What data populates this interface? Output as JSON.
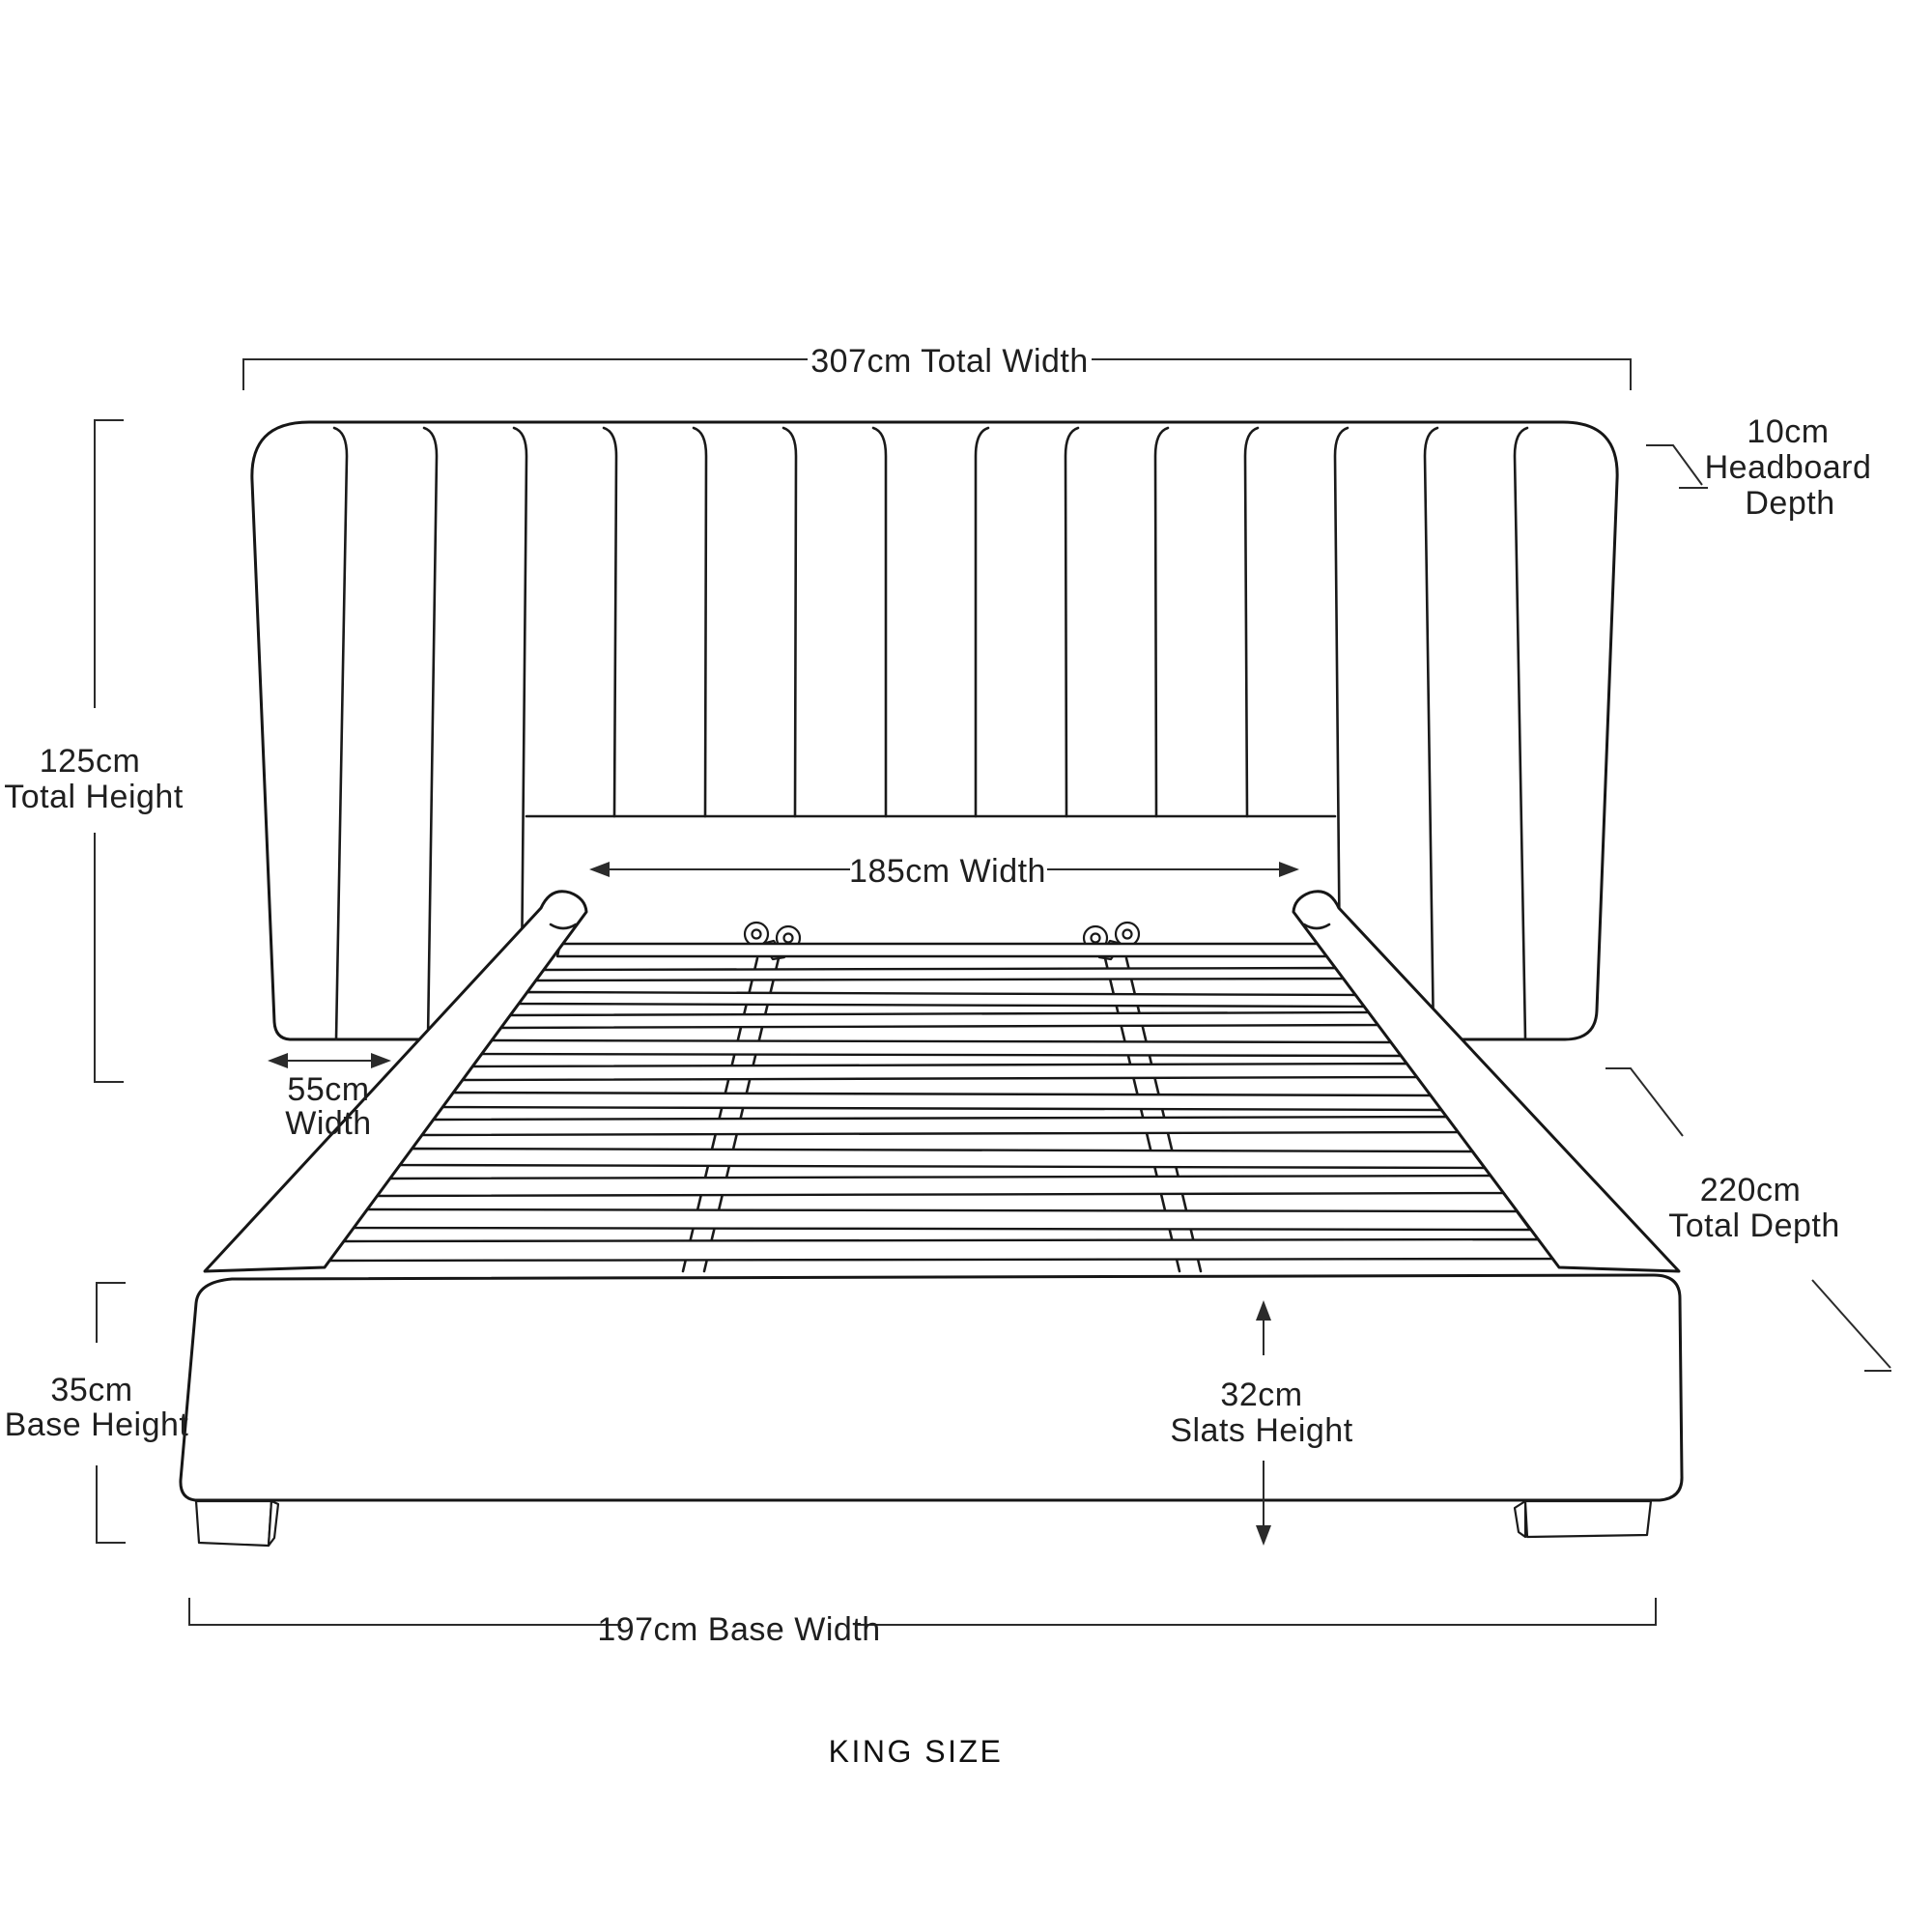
{
  "page": {
    "background": "#ffffff",
    "line_color": "#161616",
    "dimension_color": "#2b2b2b"
  },
  "diagram": {
    "labels": {
      "total_width": "307cm Total Width",
      "headboard_depth": [
        "10cm",
        "Headboard",
        "Depth"
      ],
      "total_height": [
        "125cm",
        "Total Height"
      ],
      "width": "185cm Width",
      "wing_width": [
        "55cm",
        "Width"
      ],
      "total_depth": [
        "220cm",
        "Total Depth"
      ],
      "base_height": [
        "35cm",
        "Base Height"
      ],
      "slats_height": [
        "32cm",
        "Slats Height"
      ],
      "base_width": "197cm Base Width",
      "size": "KING SIZE"
    }
  }
}
